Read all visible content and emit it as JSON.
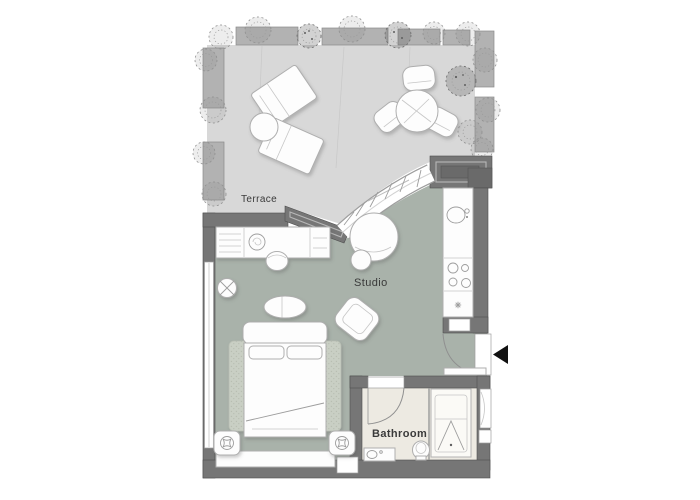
{
  "rooms": {
    "terrace": {
      "label": "Terrace"
    },
    "studio": {
      "label": "Studio"
    },
    "bathroom": {
      "label": "Bathroom"
    }
  },
  "icons": {
    "entry_arrow": "left-pointing-entry-arrow",
    "tree": "tree-plan-symbol",
    "pinwheel": "nightstand-plant-symbol",
    "asterisk": "appliance-fan-symbol"
  },
  "colors": {
    "terrace_floor": "#d8d8d8",
    "studio_floor": "#a9b2aa",
    "bathroom_floor": "#edeae2",
    "wall": "#767676",
    "planter": "#b2b2b2",
    "glazing": "#ffffff",
    "entry_arrow": "#111111",
    "label_text": "#3a3a3a"
  }
}
